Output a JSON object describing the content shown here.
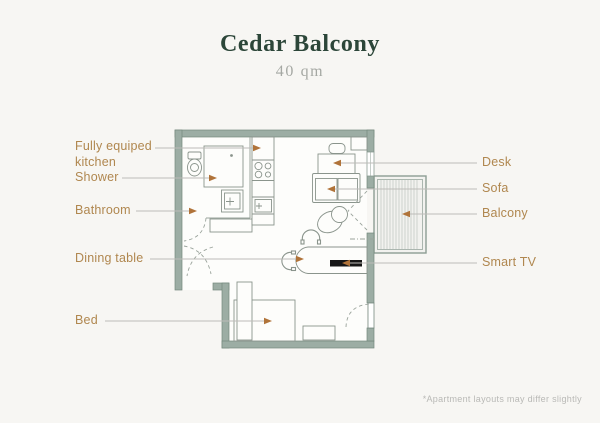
{
  "header": {
    "title": "Cedar Balcony",
    "subtitle": "40 qm"
  },
  "plan": {
    "left_labels": [
      {
        "name": "kitchen",
        "text": "Fully equiped kitchen"
      },
      {
        "name": "shower",
        "text": "Shower"
      },
      {
        "name": "bathroom",
        "text": "Bathroom"
      },
      {
        "name": "dining-table",
        "text": "Dining table"
      },
      {
        "name": "bed",
        "text": "Bed"
      }
    ],
    "right_labels": [
      {
        "name": "desk",
        "text": "Desk"
      },
      {
        "name": "sofa",
        "text": "Sofa"
      },
      {
        "name": "balcony",
        "text": "Balcony"
      },
      {
        "name": "smart-tv",
        "text": "Smart TV"
      }
    ]
  },
  "footnote": "*Apartment layouts may differ slightly",
  "colors": {
    "background": "#f7f6f3",
    "title": "#2c4639",
    "subtitle": "#a5a8a3",
    "label": "#b0874f",
    "arrow": "#b07339",
    "wall_fill": "#9cada4",
    "wall_stroke": "#74887d",
    "fixture_stroke": "#8a948c",
    "leader_line": "#bdbcb8",
    "balcony_stripe": "#c3cac5",
    "tv": "#161616"
  }
}
